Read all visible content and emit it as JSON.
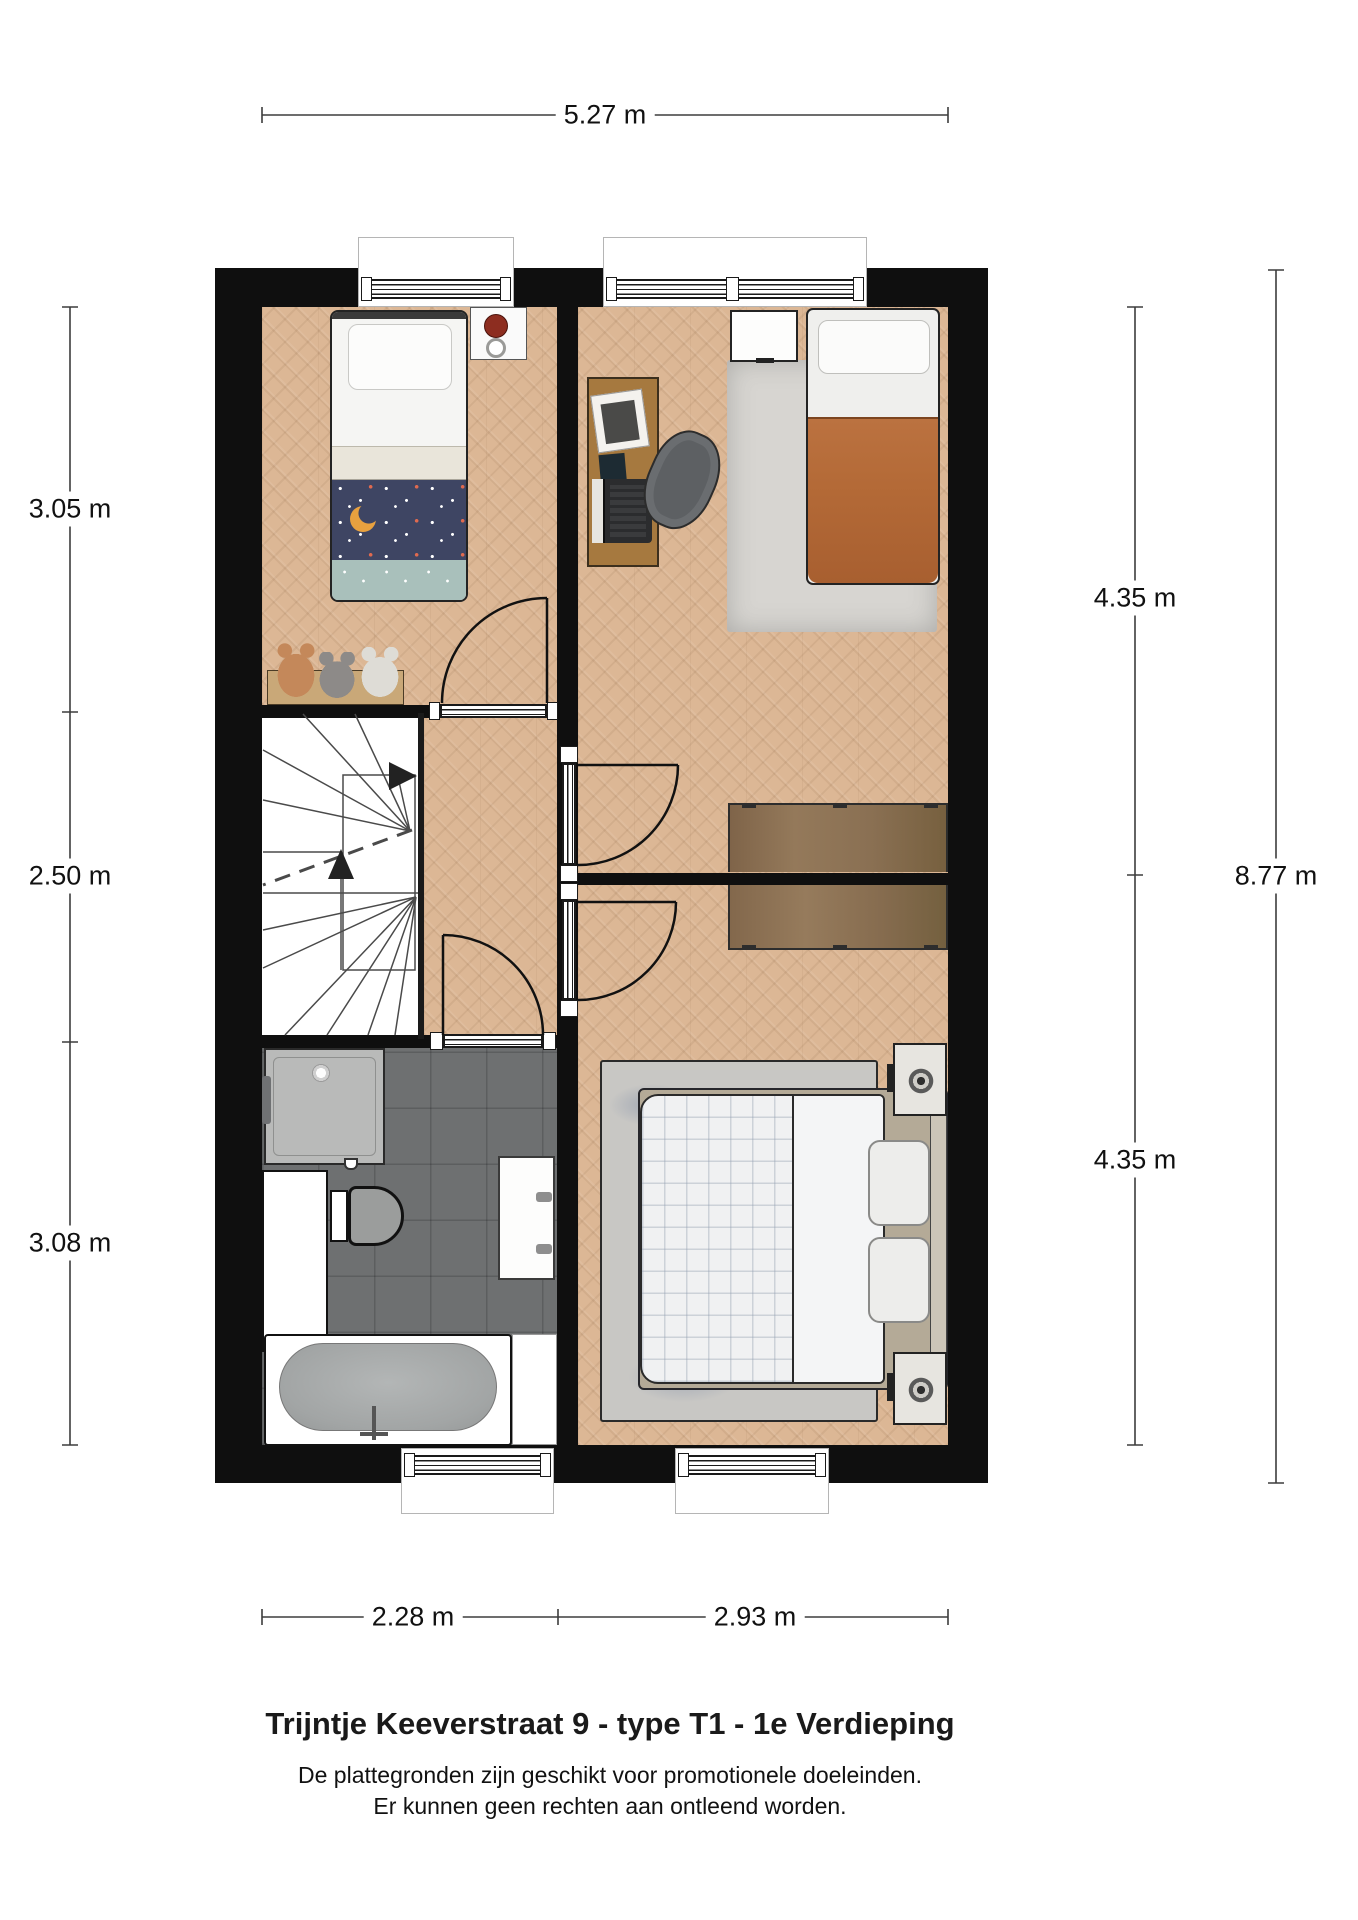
{
  "floorplan": {
    "dim_top": "5.27 m",
    "dim_left": [
      "3.05 m",
      "2.50 m",
      "3.08 m"
    ],
    "dim_right": [
      "4.35 m",
      "4.35 m"
    ],
    "dim_right_total": "8.77 m",
    "dim_bottom": [
      "2.28 m",
      "2.93 m"
    ],
    "colors": {
      "wall": "#0f0f0f",
      "wood_floor": "#dcb795",
      "bathroom_tile": "#6e7071",
      "stairwell": "#ffffff",
      "rug_bedroom2": "#d7d5d1",
      "rug_bedroom3": "#c8c7c4",
      "duvet_navy": "#3e4563",
      "duvet_teal": "#a9c0bb",
      "duvet_rust": "#b46a37",
      "duvet_white_grid": "#f0f1f2",
      "wardrobe_wood": "#8a7053",
      "desk_wood": "#a6793f",
      "clock_red": "#8d2d20"
    }
  },
  "footer": {
    "title": "Trijntje Keeverstraat 9 - type T1 - 1e Verdieping",
    "disclaimer_line1": "De plattegronden zijn geschikt voor promotionele doeleinden.",
    "disclaimer_line2": "Er kunnen geen rechten aan ontleend worden."
  }
}
